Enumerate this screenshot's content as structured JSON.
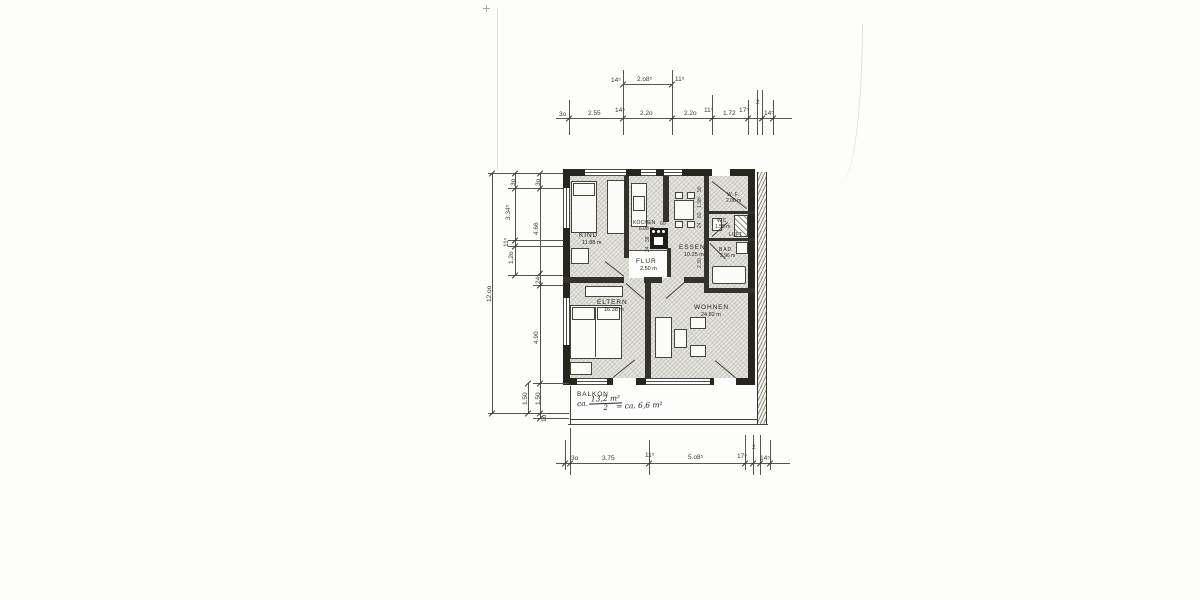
{
  "rooms": {
    "kind": {
      "name": "KIND",
      "area": "11.88 m"
    },
    "kochen": {
      "name": "KOCHEN",
      "area": "6.08 m"
    },
    "essen": {
      "name": "ESSEN",
      "area": "10.25 m"
    },
    "flur": {
      "name": "FLUR",
      "area": "2.50 m"
    },
    "wf": {
      "name": "W.F.",
      "area": "2.06 m"
    },
    "wc": {
      "name": "WC",
      "area": "1.55 m"
    },
    "luft": {
      "name": "LUFT"
    },
    "bad": {
      "name": "BAD",
      "area": "3.96 m"
    },
    "eltern": {
      "name": "ELTERN",
      "area": "16.38 m"
    },
    "wohnen": {
      "name": "WOHNEN",
      "area": "24.82 m"
    },
    "balkon": {
      "name": "BALKON"
    }
  },
  "balkon_note": {
    "prefix": "ca.",
    "numerator": "13,2 m²",
    "denominator": "2",
    "result": "= ca. 6,6 m²"
  },
  "dims": {
    "overall_height": "12.oo",
    "top_secondary": [
      "14⁵",
      "2.o8⁵",
      "11⁵"
    ],
    "top_main": [
      "3o",
      "2.55",
      "14⁵",
      "2.2o",
      "2.2o",
      "11⁵",
      "1.72",
      "17⁵",
      "2",
      "14⁵"
    ],
    "left_outer": [
      "3o",
      "3.34⁵",
      "11⁵",
      "1.2o"
    ],
    "left_inner": [
      "3o",
      "4.66",
      "24",
      "4.90",
      "1.50",
      "1o"
    ],
    "left_balcony": "1.50",
    "bottom": [
      "3o",
      "3.75",
      "11⁵",
      "5.o8⁵",
      "17⁵",
      "2",
      "14⁵"
    ],
    "interior_right": [
      "90",
      "1.38⁵",
      "60",
      "24",
      "2.30"
    ],
    "interior_kitchen": [
      "38",
      "24",
      "60"
    ]
  },
  "colors": {
    "ink": "#2b2b28",
    "paper": "#fdfdfb",
    "room_fill": "#e6e4df"
  }
}
